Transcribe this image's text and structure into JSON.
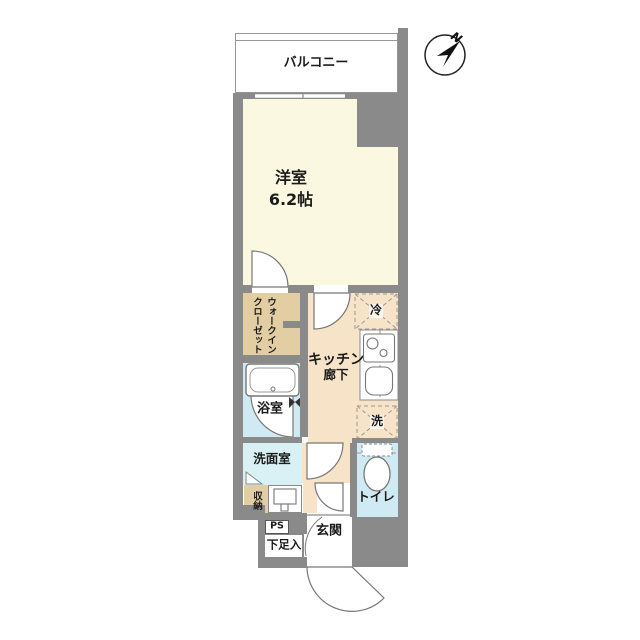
{
  "floor_plan": {
    "balcony": "バルコニー",
    "western_room": {
      "name": "洋室",
      "size": "6.2帖"
    },
    "walk_in_closet": {
      "line1": "ウォークイン",
      "line2": "クローゼット"
    },
    "kitchen": {
      "line1": "キッチン",
      "line2": "廊下"
    },
    "bathroom": "浴室",
    "washroom": "洗面室",
    "storage": "収納",
    "pipe_space": "PS",
    "shoe_cabinet": "下足入",
    "entrance": "玄関",
    "toilet": "トイレ",
    "refrigerator": "冷",
    "washer": "洗"
  },
  "compass": {
    "north": "N"
  },
  "colors": {
    "wall": "#8a8a8a",
    "western_room": "#faf8e1",
    "closet_tan": "#e3cda3",
    "corridor_peach": "#f6e3c8",
    "bathroom_blue": "#cfeaf2",
    "washroom_blue": "#d9f1f5",
    "toilet_blue": "#cfeaf2",
    "line": "#777777",
    "text": "#1b1b1b",
    "background": "#ffffff"
  }
}
